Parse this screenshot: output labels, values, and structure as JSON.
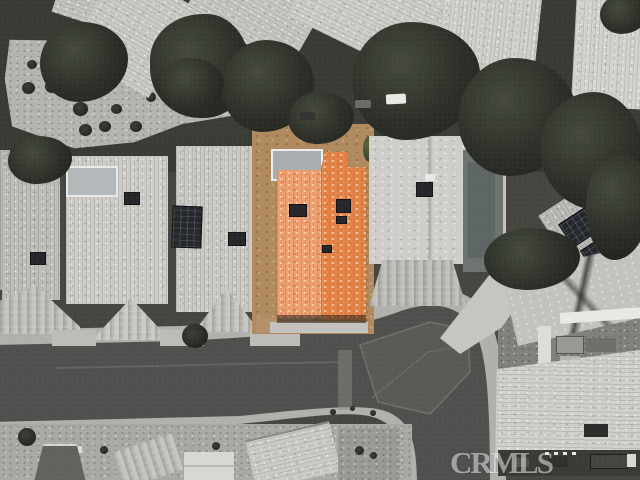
{
  "photo": {
    "kind": "aerial-satellite-view",
    "watermark": {
      "text": "CRMLS"
    },
    "palette": {
      "highlight_roof_light": "#F0A173",
      "highlight_roof_deep": "#E58549",
      "neutral_roof_light": "#CCCBC7",
      "asphalt_road": "#4F4F4D",
      "sidewalk_concrete": "#B1B0AC",
      "tree_canopy": "#2C2F28",
      "bare_dirt": "#B08A5E",
      "pool_cover": "#6D736F"
    },
    "features": {
      "highlighted_home": "orange-tile-roof-home-center",
      "road": "curved-residential-street",
      "surroundings": "grayscale-townhomes-and-trees"
    }
  }
}
